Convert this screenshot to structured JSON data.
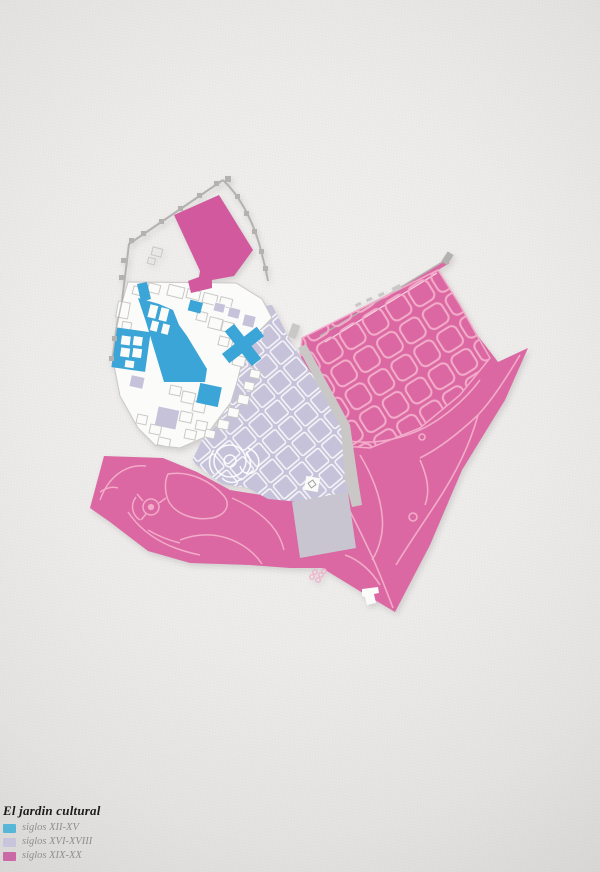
{
  "legend": {
    "title": "El jardin cultural",
    "items": [
      {
        "label": "siglos XII-XV",
        "color": "#58b6d9"
      },
      {
        "label": "siglos XVI-XVIII",
        "color": "#c7c4db"
      },
      {
        "label": "siglos XIX-XX",
        "color": "#cb69a6"
      }
    ]
  },
  "map": {
    "colors": {
      "blue": "#3aa5d6",
      "lavender": "#c6c2d9",
      "lavender_muted": "#c8c5d1",
      "pink": "#db68a2",
      "pink_deep": "#d2599e",
      "pink_line": "#f2abc9",
      "wall_gray": "#b3b2b0",
      "road_gray": "#c9c8c6",
      "building_white": "#fbfbfa",
      "building_outline": "#c9c8c6"
    }
  }
}
